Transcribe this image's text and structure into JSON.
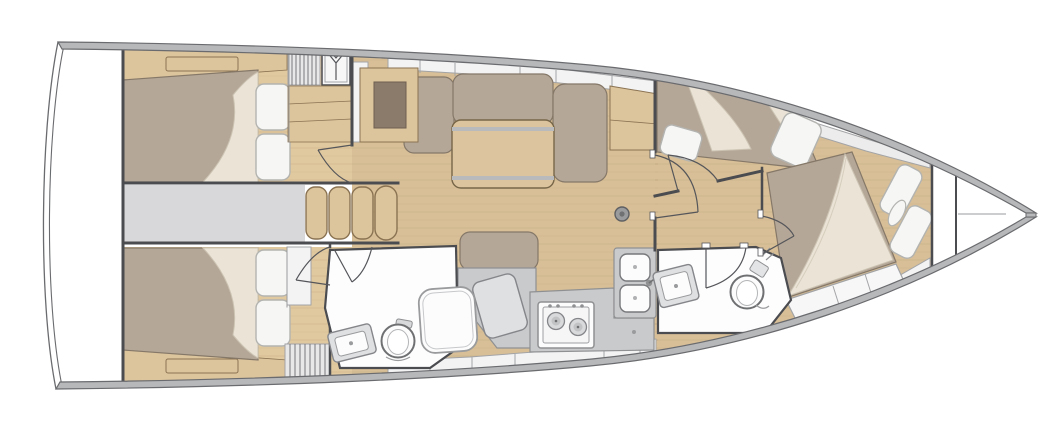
{
  "figure": {
    "kind": "sailboat-interior-floor-plan",
    "view": "top-down",
    "orientation": "bow-right-stern-left",
    "background": "#ffffff"
  },
  "colors": {
    "hullBand": "#b7b8ba",
    "hullLine": "#6a6b6e",
    "wall": "#4b4c50",
    "floorSalon": "#d8bf97",
    "floorCabin": "#e1c99f",
    "woodTrim": "#dcc49c",
    "woodDark": "#8b7b6b",
    "woodEdge": "#8a7352",
    "table": "#dcc49e",
    "tableStripe": "#b9babc",
    "mattress": "#b5a798",
    "mattressEdge": "#857868",
    "sheet": "#eae3d6",
    "sheetEdge": "#ccc3b2",
    "pillow": "#f6f6f5",
    "pillowEdge": "#b3b3b0",
    "counter": "#c9cacc",
    "counterEdge": "#8f9092",
    "counterLight": "#dfe0e1",
    "fixture": "#fcfcfd",
    "fixtureEdge": "#77787b",
    "locker": "#f3f3f4",
    "lockerEdge": "#a3a4a6",
    "grayZone": "#d8d8da",
    "deckWedge": "#ececed",
    "steel": "#9a9b9d",
    "room": "#fdfdfe",
    "slat": "#e8e8e9",
    "slatLine": "#77787a"
  },
  "rooms": [
    {
      "name": "aft-port-cabin",
      "furniture": [
        "double-berth",
        "two-pillows",
        "headboard-drawer",
        "slatted-locker",
        "hanging-locker",
        "bench"
      ]
    },
    {
      "name": "aft-starboard-cabin",
      "furniture": [
        "double-berth",
        "two-pillows",
        "headboard-drawer",
        "slatted-locker",
        "cabinet"
      ]
    },
    {
      "name": "companionway",
      "furniture": [
        "four-wood-steps"
      ]
    },
    {
      "name": "salon",
      "furniture": [
        "l-settee",
        "chaise-cushion",
        "folding-table",
        "sideboard",
        "chart-desk",
        "mast-post"
      ]
    },
    {
      "name": "nav-station",
      "furniture": [
        "seat-cushion",
        "chart-console"
      ]
    },
    {
      "name": "galley",
      "furniture": [
        "two-burner-stove",
        "double-sink",
        "counters"
      ]
    },
    {
      "name": "aft-head",
      "furniture": [
        "toilet",
        "vanity-sink",
        "shower-glass"
      ]
    },
    {
      "name": "forward-port-cabin",
      "furniture": [
        "double-berth",
        "two-pillows"
      ]
    },
    {
      "name": "forward-head",
      "furniture": [
        "toilet",
        "vanity-sink"
      ]
    },
    {
      "name": "bow-owner-cabin",
      "furniture": [
        "island-berth",
        "two-pillows",
        "bolster",
        "foot-locker"
      ]
    },
    {
      "name": "anchor-locker",
      "furniture": [
        "bulkheads"
      ]
    }
  ],
  "icons": {
    "hanging_locker_symbol": "clothes-hanger"
  }
}
